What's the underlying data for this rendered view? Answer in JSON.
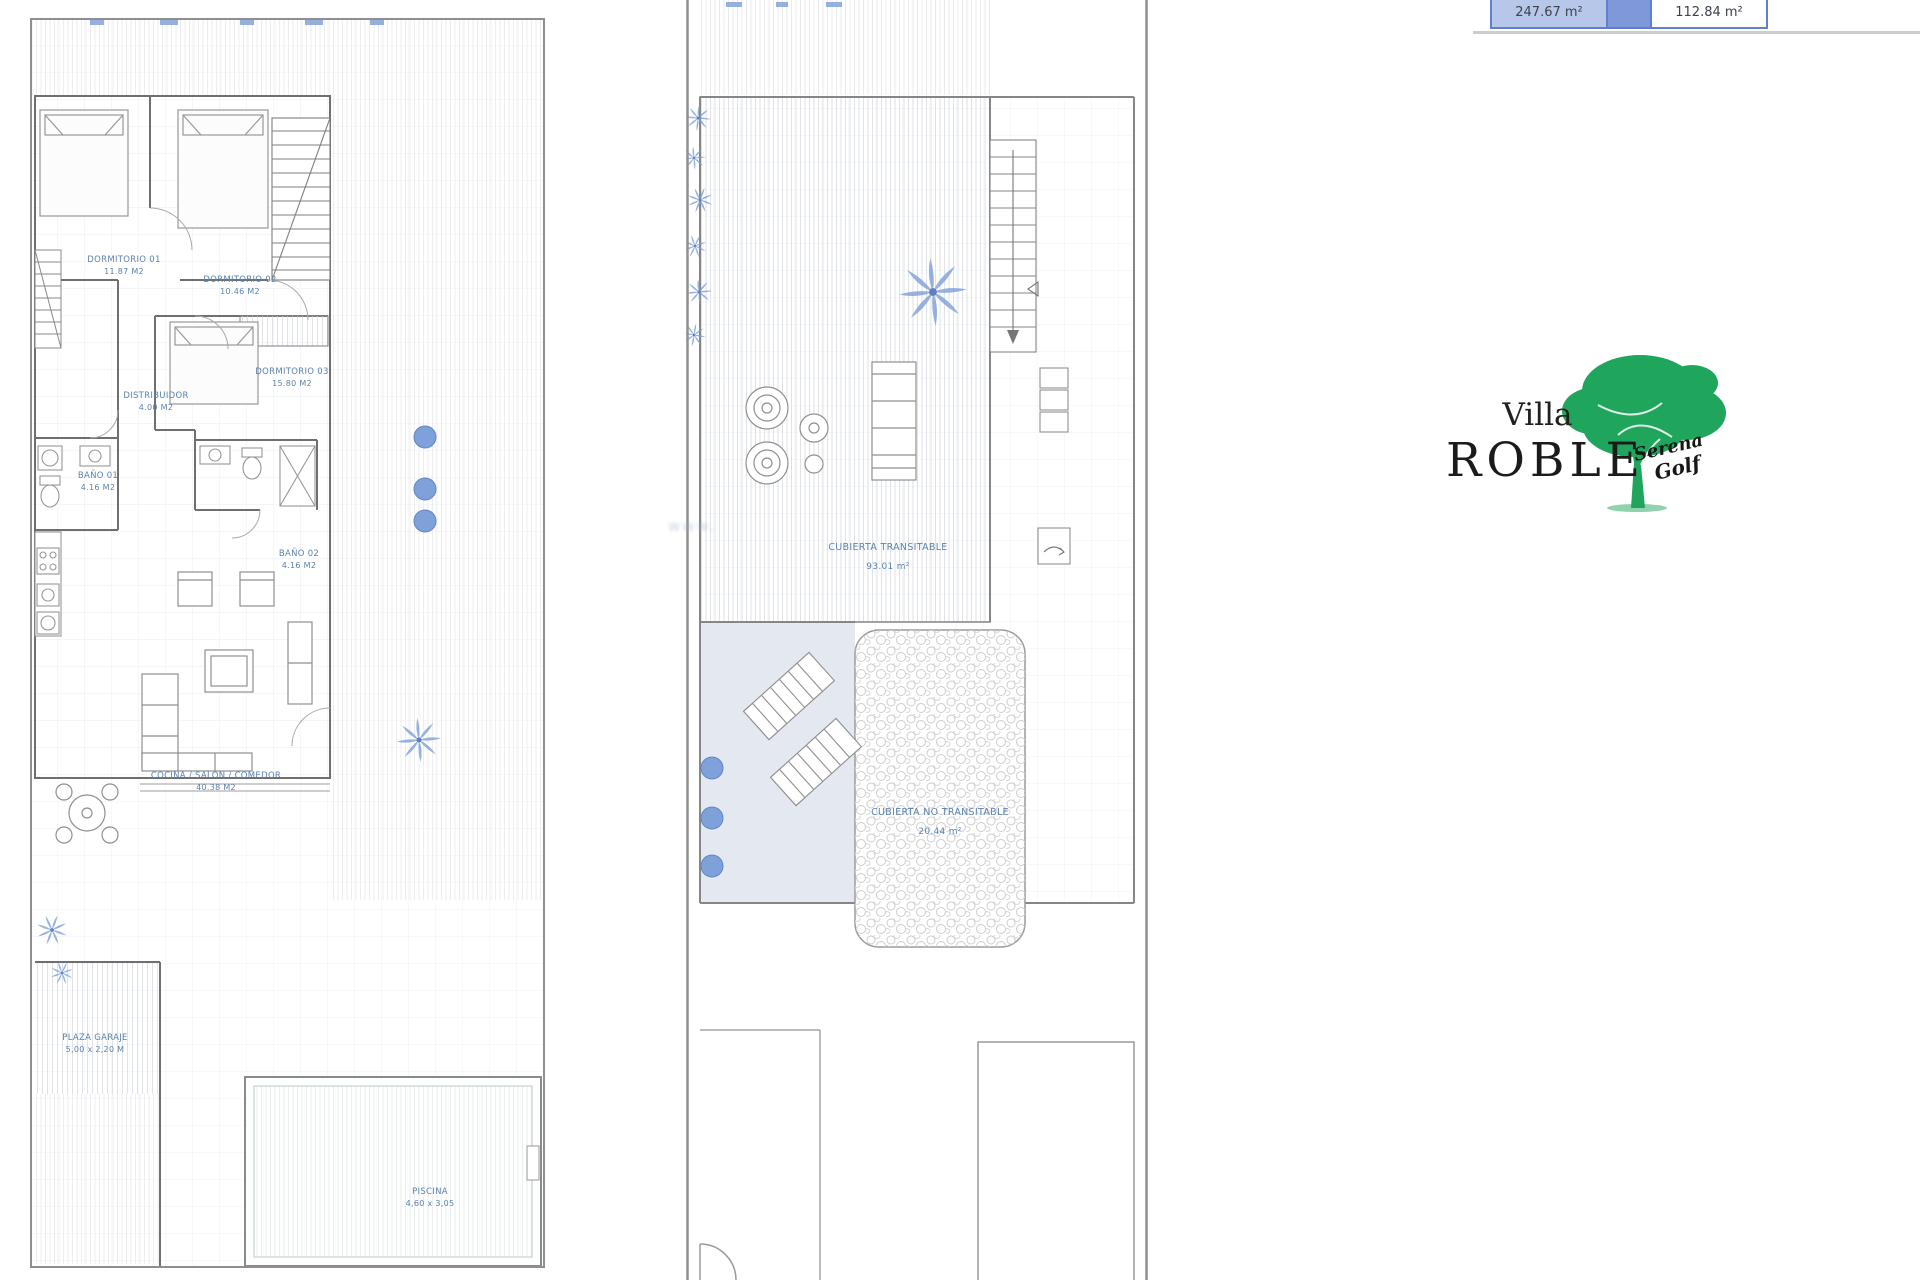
{
  "watermark": {
    "text": "www."
  },
  "area_table": {
    "left_value": "247.67 m²",
    "right_value": "112.84 m²"
  },
  "logo": {
    "villa": "Villa",
    "roble": "ROBLE",
    "script_line1": "Serena",
    "script_line2": "Golf"
  },
  "ground": {
    "rooms": [
      {
        "name": "DORMITORIO 01",
        "area": "11.87 M2"
      },
      {
        "name": "DORMITORIO 02",
        "area": "10.46 M2"
      },
      {
        "name": "DORMITORIO 03",
        "area": "15.80 M2"
      },
      {
        "name": "DISTRIBUIDOR",
        "area": "4.00 M2"
      },
      {
        "name": "BAÑO 01",
        "area": "4.16 M2"
      },
      {
        "name": "BAÑO 02",
        "area": "4.16 M2"
      },
      {
        "name": "COCINA / SALON / COMEDOR",
        "area": "40.38 M2"
      },
      {
        "name": "PLAZA GARAJE",
        "area": "5,00 x 2,20 M"
      },
      {
        "name": "PISCINA",
        "area": "4,60 x 3,05"
      }
    ]
  },
  "roof": {
    "rooms": [
      {
        "name": "CUBIERTA TRANSITABLE",
        "area": "93.01 m²"
      },
      {
        "name": "CUBIERTA NO TRANSITABLE",
        "area": "20.44 m²"
      }
    ]
  },
  "colors": {
    "accent_blue": "#5f7fd2",
    "cell_blue": "#b7c7ea",
    "label_blue": "#5b82ad",
    "deco_blue": "#7d9fd8",
    "logo_green": "#1fa55c"
  }
}
